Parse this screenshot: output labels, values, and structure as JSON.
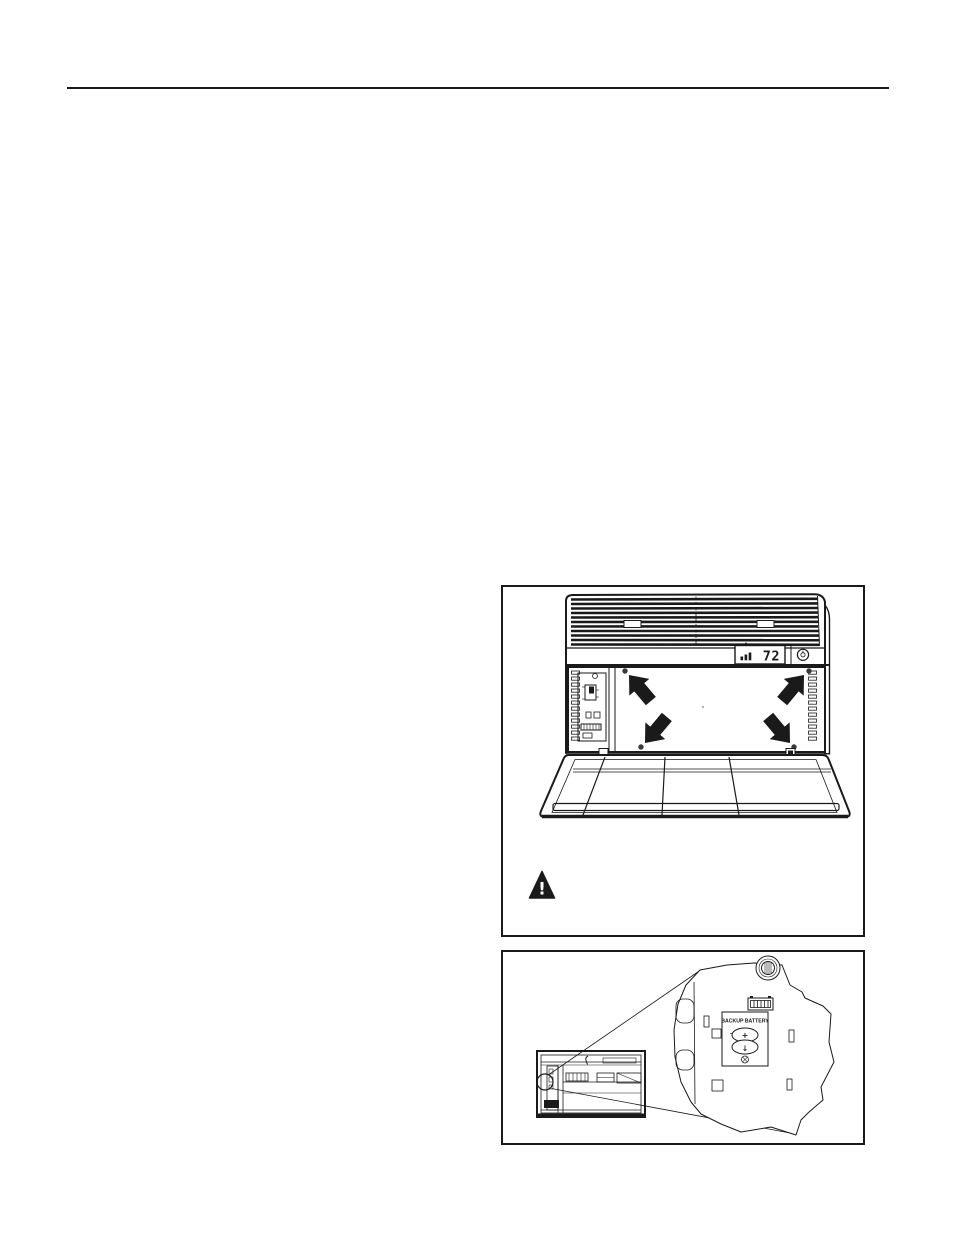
{
  "page": {
    "type": "manual-page",
    "background": "#ffffff",
    "ink": "#1a1a1a"
  },
  "figure_grille_removal": {
    "display_temperature": "72",
    "warning_glyph": "!",
    "icons": [
      "fan-speed-bars-icon",
      "power-button-icon",
      "warning-triangle-icon",
      "screw-dot-icon",
      "removal-arrow-icon"
    ]
  },
  "figure_backup_battery": {
    "compartment_label": "BACKUP BATTERY",
    "battery_positive_symbol": "+",
    "battery_insert_symbol": "↓",
    "icons": [
      "mounting-screw-head-icon",
      "wire-connector-icon",
      "coin-battery-icon",
      "phillips-screw-icon",
      "callout-circle-icon"
    ]
  }
}
